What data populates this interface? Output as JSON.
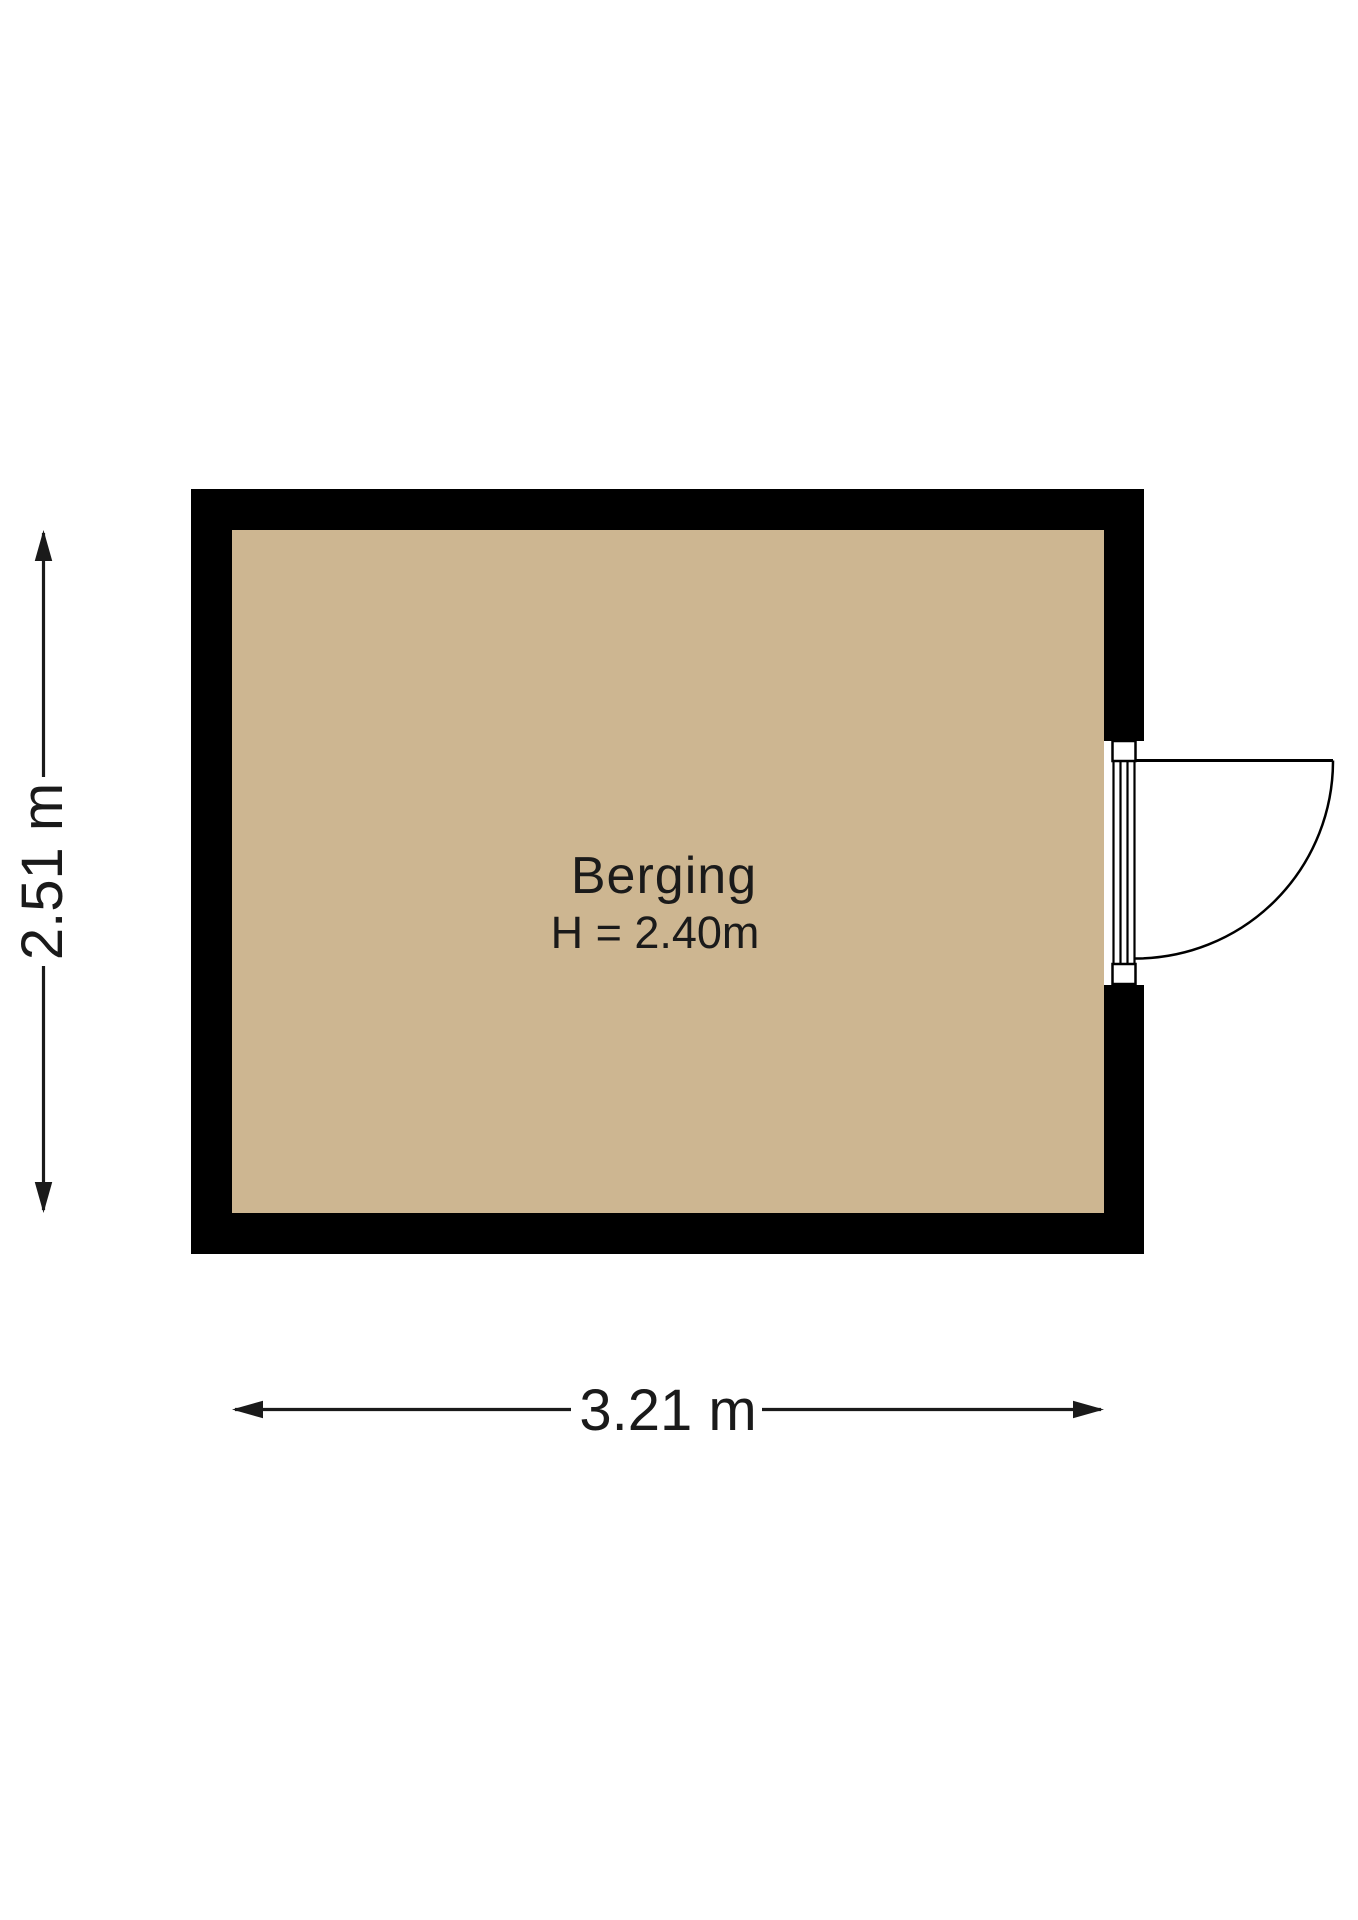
{
  "colors": {
    "background": "#ffffff",
    "wall": "#000000",
    "floor": "#cdb691",
    "line": "#1a1a1a",
    "text": "#1a1a1a"
  },
  "room": {
    "name": "Berging",
    "ceiling_height": "H = 2.40m"
  },
  "dimensions": {
    "horizontal": "3.21 m",
    "vertical": "2.51 m"
  }
}
